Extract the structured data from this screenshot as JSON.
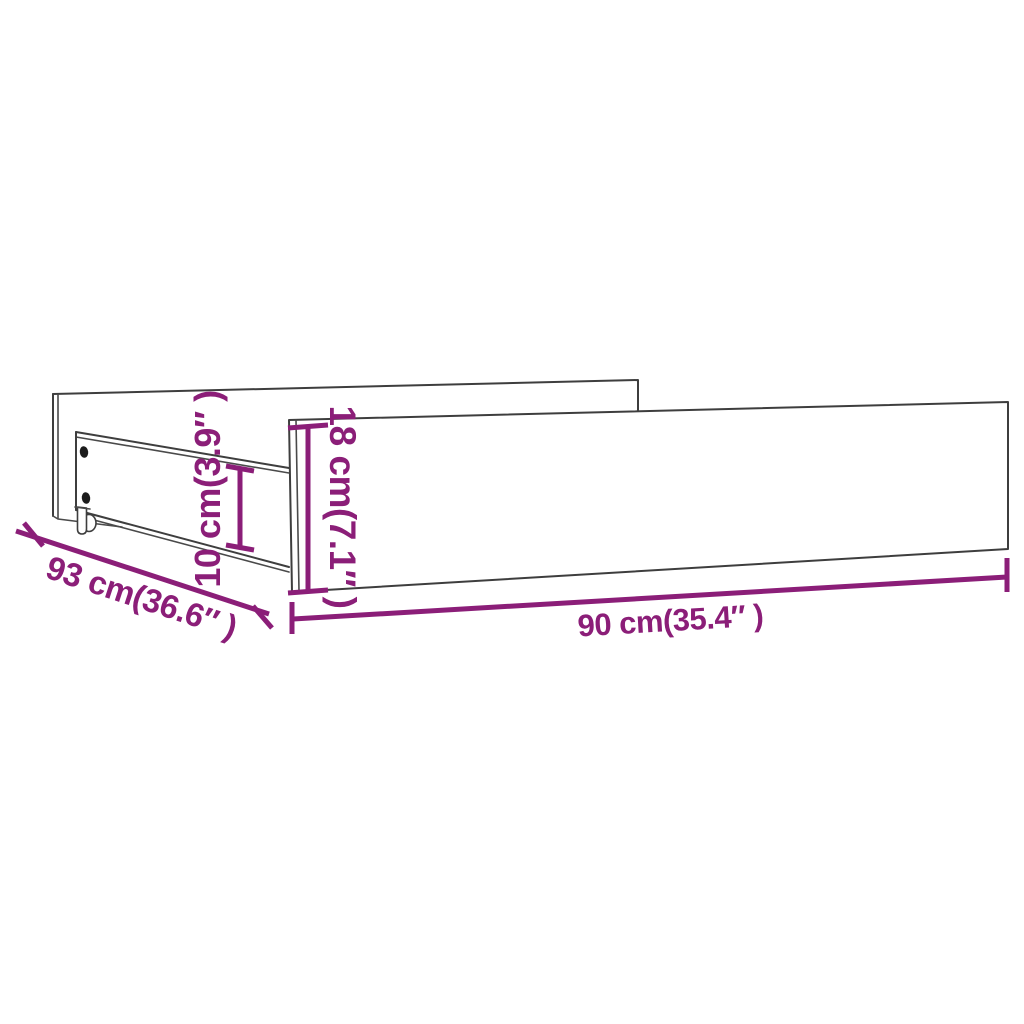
{
  "diagram": {
    "kind": "product-dimension-diagram",
    "subject": "under-bed storage drawers with casters",
    "background": "#ffffff",
    "colors": {
      "dimension_accent": "#8b1e78",
      "outline": "#3e3e3e",
      "screw_hole": "#1c1c1c"
    },
    "dimensions": {
      "depth": {
        "label": "93 cm(36.6″ )",
        "cm": 93,
        "inches": 36.6
      },
      "width": {
        "label": "90 cm(35.4″ )",
        "cm": 90,
        "inches": 35.4
      },
      "front_height": {
        "label": "18 cm(7.1″ )",
        "cm": 18,
        "inches": 7.1
      },
      "rail_height": {
        "label": "10 cm(3.9″ )",
        "cm": 10,
        "inches": 3.9
      }
    }
  }
}
